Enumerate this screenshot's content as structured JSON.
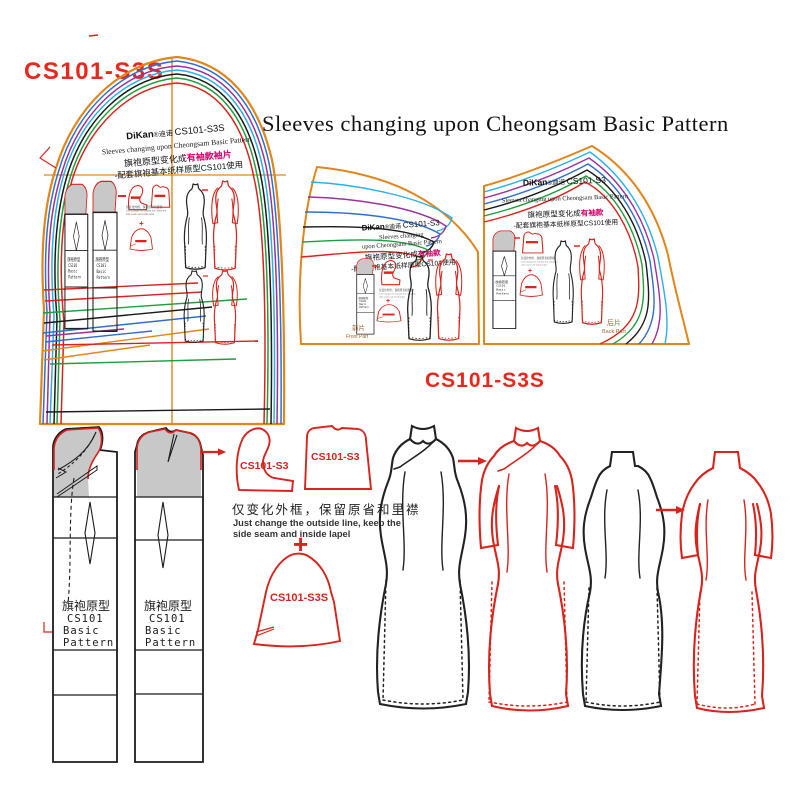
{
  "page": {
    "code_top_left": "CS101-S3S",
    "title": "Sleeves changing upon Cheongsam  Basic Pattern",
    "code_center": "CS101-S3S"
  },
  "colors": {
    "red": "#d8241c",
    "orange": "#e0861a",
    "blue": "#2f6fce",
    "purple": "#993399",
    "cyan": "#2ab0e8",
    "black": "#1a1a1a",
    "green": "#1f9e3e",
    "magenta": "#d4006a",
    "gray_fill": "#c8c8c8"
  },
  "sleeve_piece": {
    "brand": "DiKan",
    "brand_suffix": "®迪诺 ",
    "code": "CS101-S3S",
    "subtitle_en": "Sleeves changing upon Cheongsam  Basic Pattern",
    "cn_line1": "旗袍原型变化成",
    "cn_line1_highlight": "有袖款袖片",
    "cn_line2": "-配套旗袍基本纸样原型CS101使用"
  },
  "front_piece": {
    "brand": "DiKan",
    "brand_suffix": "®迪诺 ",
    "code": "CS101-S3",
    "subtitle_en1": "Sleeves changing",
    "subtitle_en2": "upon Cheongsam  Basic Pattern",
    "cn_line1": "旗袍原型变化成",
    "cn_line1_highlight": "有袖款",
    "cn_line2": "-配套旗袍基本纸样原型CS101使用",
    "label_cn": "前片",
    "label_en": "Front Part"
  },
  "back_piece": {
    "brand": "DiKan",
    "brand_suffix": "®迪诺 ",
    "code": "CS101-S3",
    "subtitle_en": "Sleeves changing upon Cheongsam  Basic Pattern",
    "cn_line1": "旗袍原型变化成",
    "cn_line1_highlight": "有袖款",
    "cn_line2": "-配套旗袍基本纸样原型CS101使用",
    "label_cn": "后片",
    "label_en": "Back Part"
  },
  "basic_block": {
    "lines": [
      "旗袍原型",
      "CS101",
      "Basic",
      "Pattern"
    ]
  },
  "steps": {
    "front_bodice_code": "CS101-S3",
    "back_bodice_code": "CS101-S3",
    "note_cn": "仅变化外框，保留原省和里襟",
    "note_en1": "Just change the outside line, keep the",
    "note_en2": "side seam and inside lapel",
    "plus": "+",
    "sleeve_code": "CS101-S3S"
  }
}
